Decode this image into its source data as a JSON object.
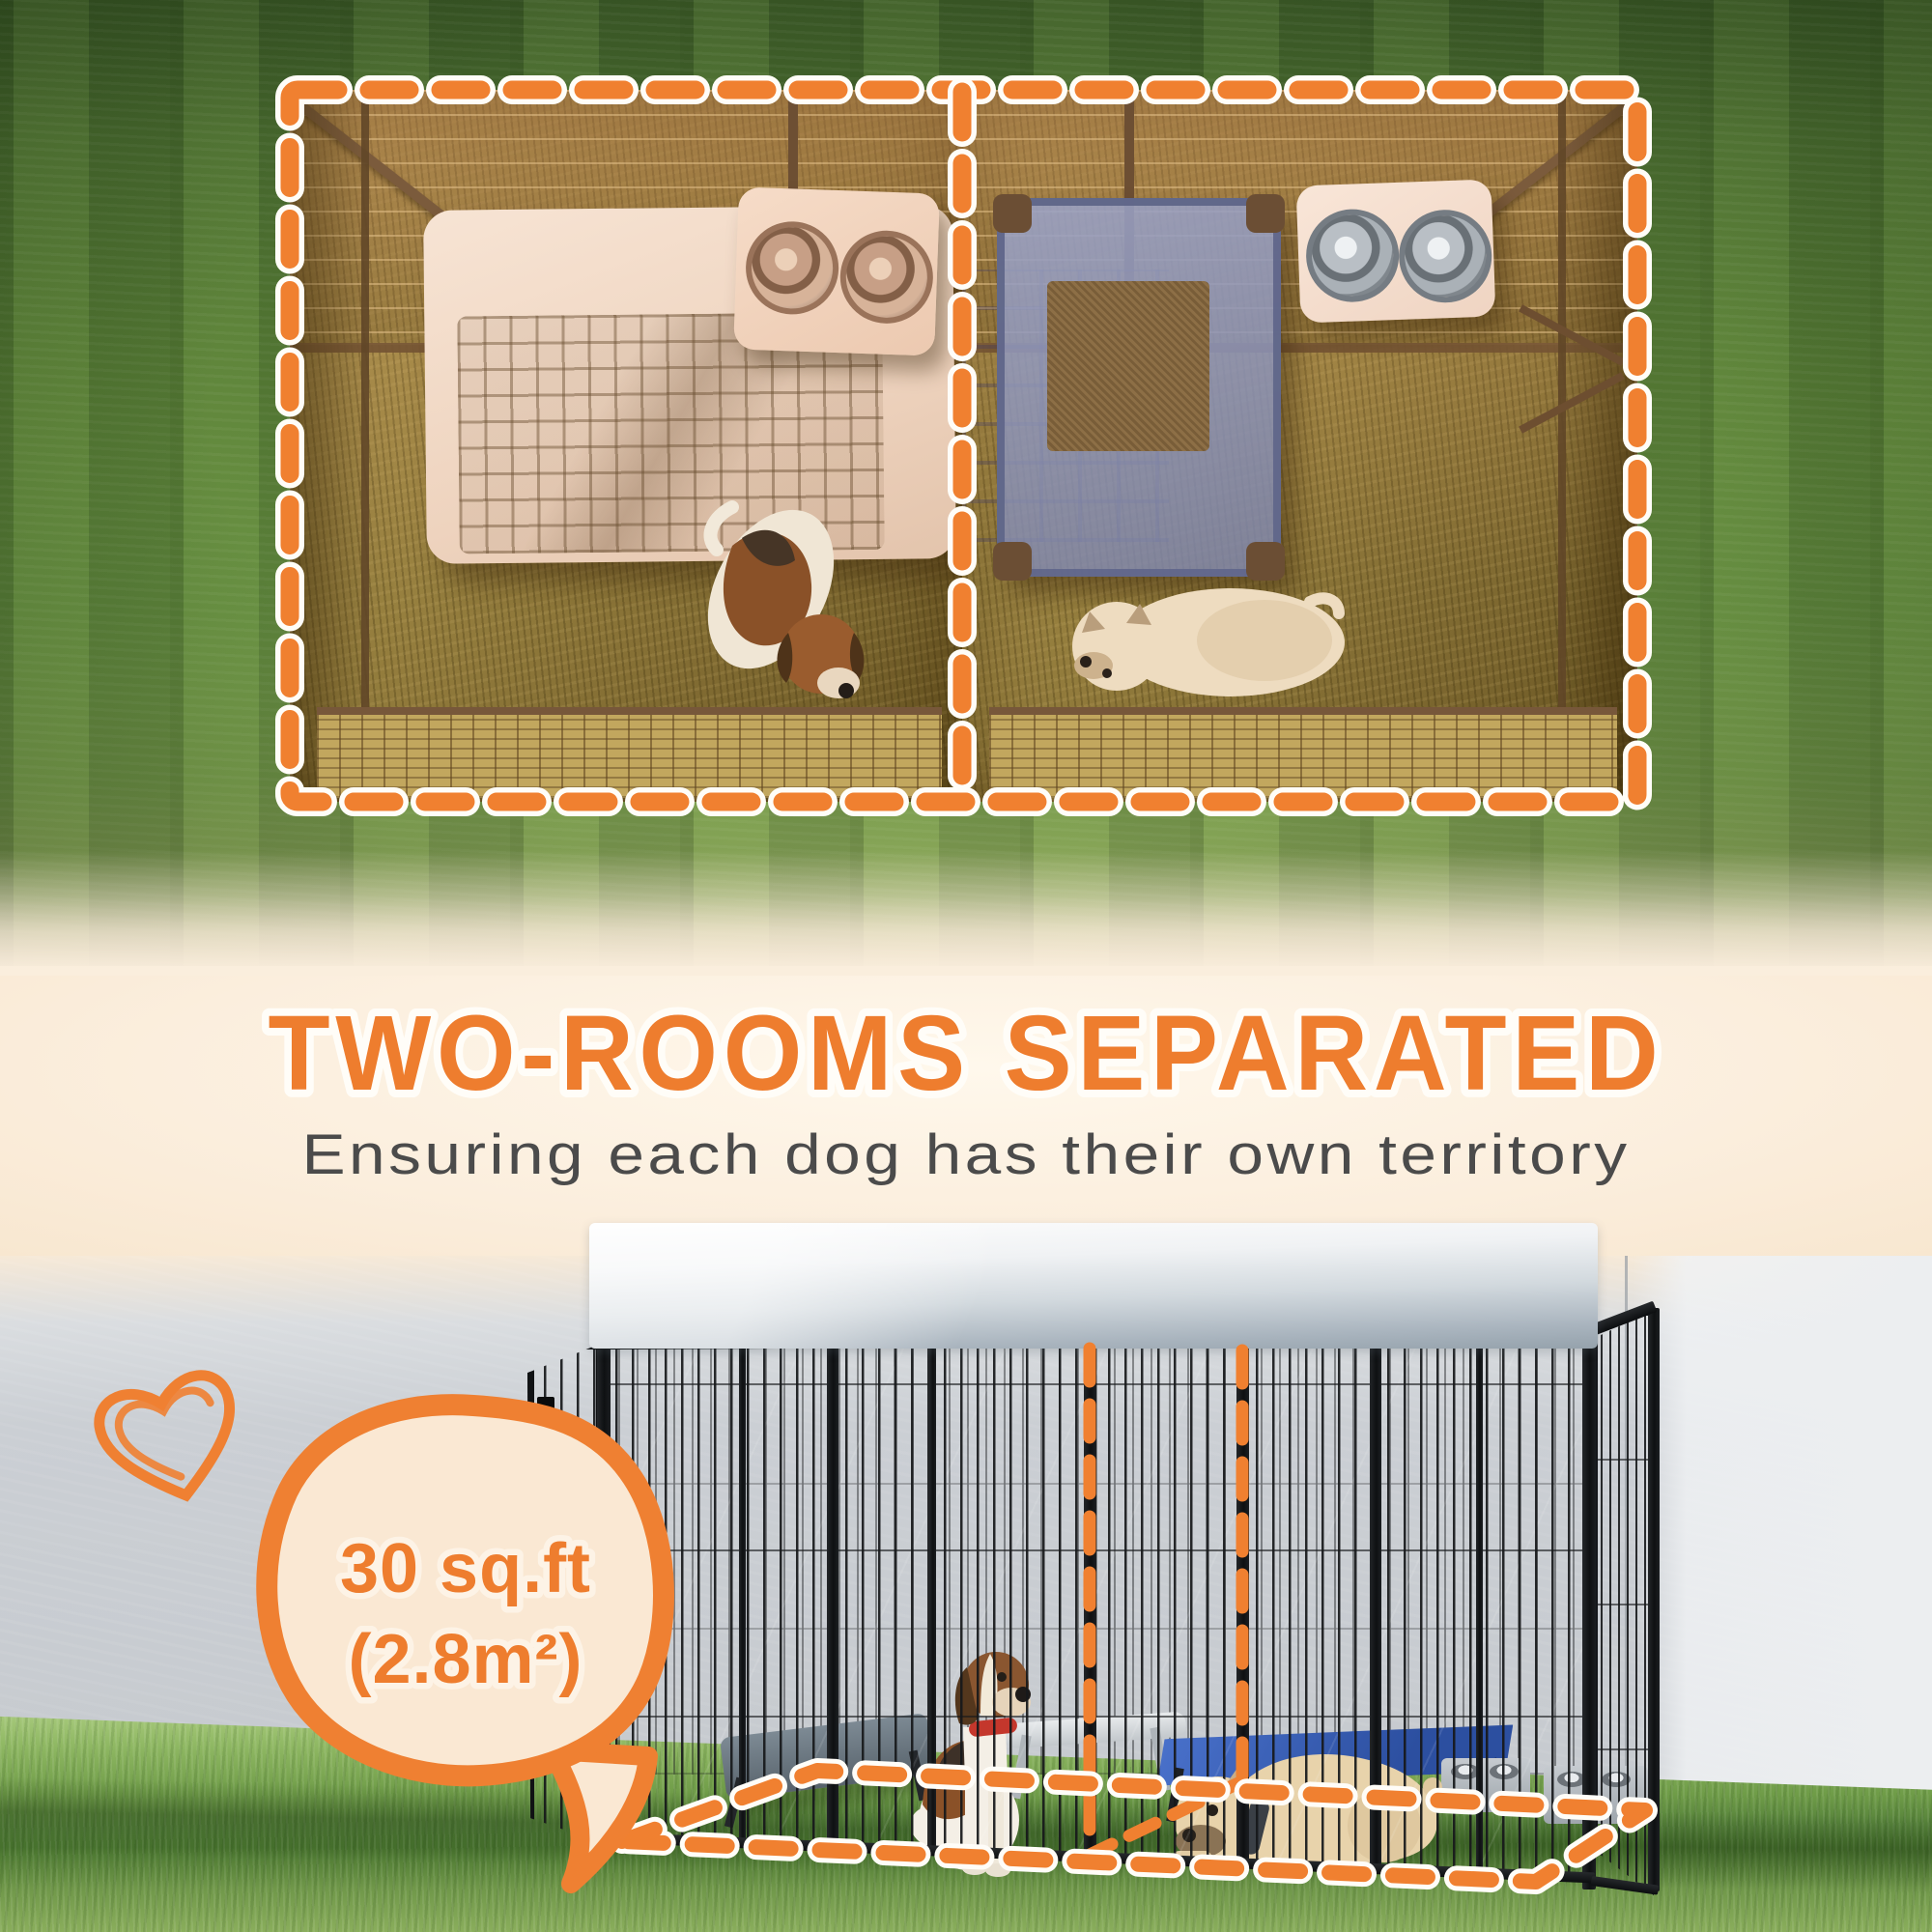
{
  "headline": {
    "title": "TWO-ROOMS SEPARATED",
    "subtitle": "Ensuring each dog has their own territory"
  },
  "callout": {
    "line1": "30 sq.ft",
    "line2": "(2.8m²)"
  },
  "colors": {
    "accent_orange": "#EE7D2E",
    "dash_orange": "#F08030",
    "bubble_fill": "#FAE8D3",
    "title_color": "#EE7D2E",
    "subtitle_color": "#4B4B4B"
  },
  "icons": {
    "heart": "heart-doodle-icon"
  },
  "scene": {
    "top_view": "aerial view of two-room dog kennel with beagle in left room and french bulldog in right room",
    "bottom_view": "outdoor kennel with white cover, black wire panels, two dogs, orange dashed footprint"
  }
}
